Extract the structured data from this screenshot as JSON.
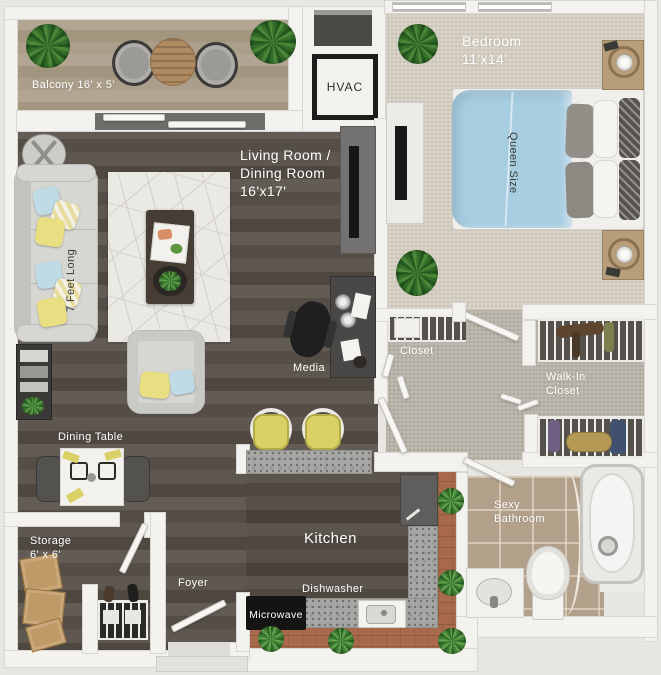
{
  "rooms": {
    "balcony": {
      "label": "Balcony 16' x 5'"
    },
    "bedroom": {
      "name": "Bedroom",
      "dims": "11'x14'"
    },
    "living": {
      "line1": "Living Room /",
      "line2": "Dining Room",
      "dims": "16'x17'"
    },
    "closet": {
      "label": "Closet"
    },
    "walk_in_closet": {
      "line1": "Walk-In",
      "line2": "Closet"
    },
    "bathroom": {
      "line1": "Sexy",
      "line2": "Bathroom"
    },
    "kitchen": {
      "label": "Kitchen"
    },
    "foyer": {
      "label": "Foyer"
    },
    "storage": {
      "name": "Storage",
      "dims": "6' x 6'"
    },
    "dining": {
      "label": "Dining Table"
    }
  },
  "appliances": {
    "hvac": "HVAC",
    "microwave": "Microwave",
    "dishwasher": "Dishwasher"
  },
  "furniture": {
    "sofa": "7 Feet Long",
    "bed": "Queen Size",
    "media": "Media"
  },
  "colors": {
    "background": "#e8e6e1",
    "wall": "#f3f2ee",
    "wall_edge": "#d8d6d0",
    "wood": "#5b544d",
    "bedroom_carpet": "#cfc8ba",
    "hall_carpet": "#b2ada3",
    "bath_tile": "#b3a08b",
    "terracotta": "#a86a4b",
    "rug": "#eae9e4",
    "sofa_gray": "#d6d6d3",
    "dark_furniture": "#4a4846",
    "accent_yellow": "#e7df82",
    "accent_blue": "#bedbe6",
    "bed_blue": "#a7cde1",
    "plant_green": "#4c8a3a"
  }
}
